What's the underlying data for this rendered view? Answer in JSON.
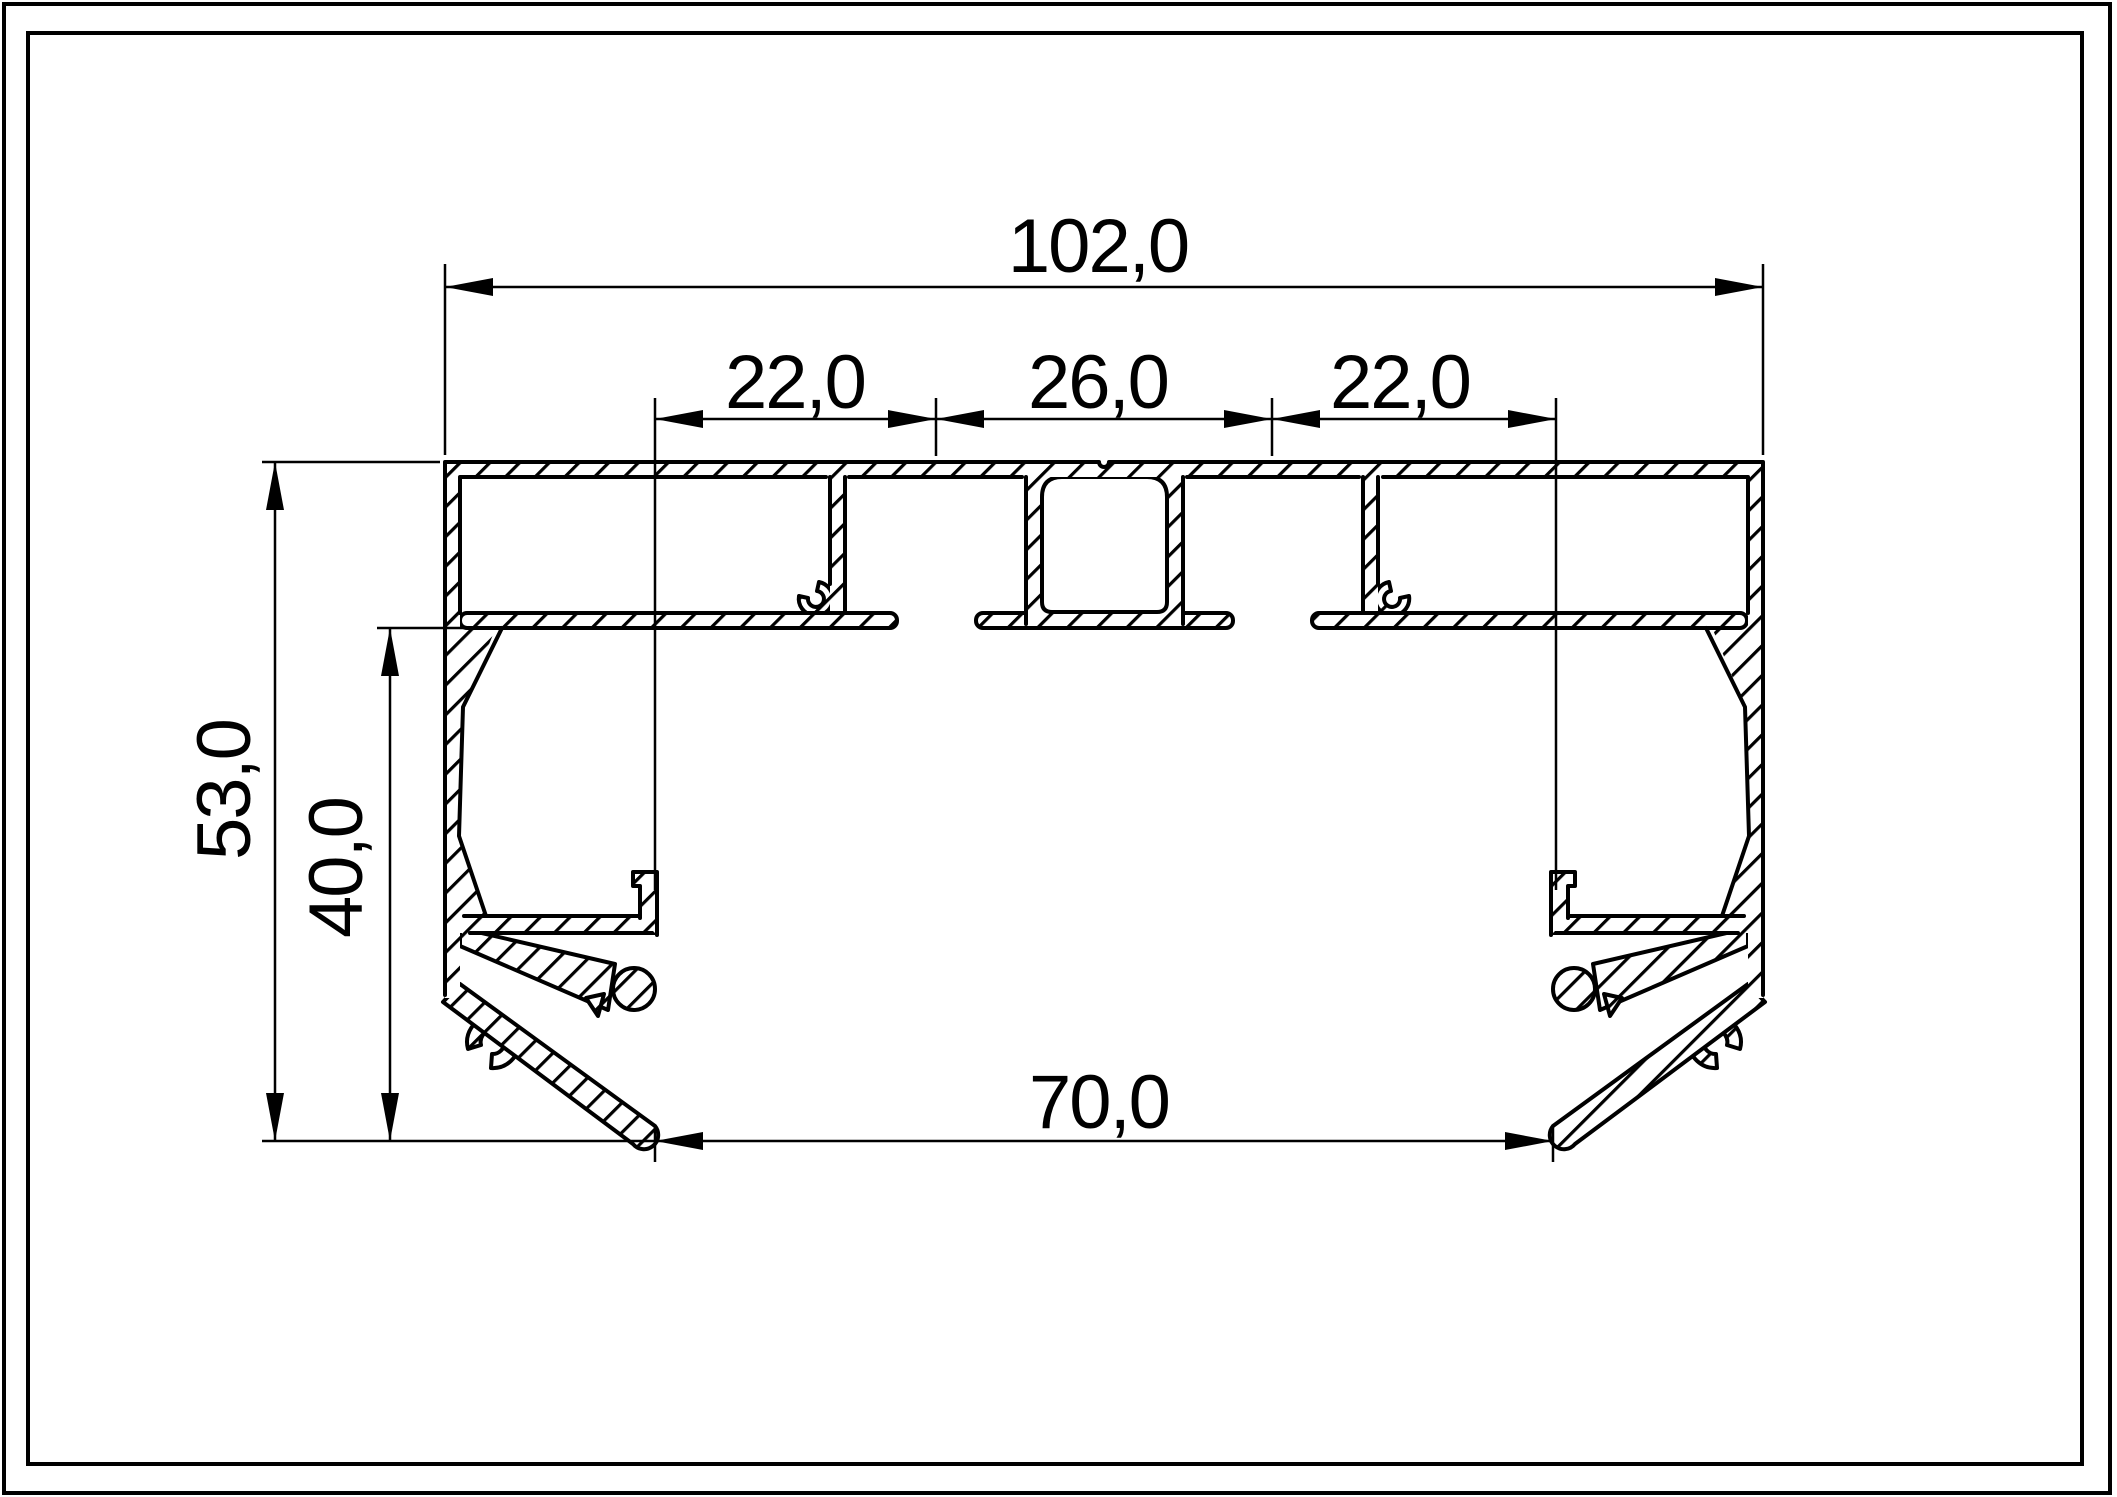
{
  "drawing": {
    "kind": "extrusion-profile-cross-section",
    "line_color": "#000000",
    "background_color": "#ffffff",
    "dimensions": {
      "overall_width": "102,0",
      "top_slot_left": "22,0",
      "top_center": "26,0",
      "top_slot_right": "22,0",
      "overall_height": "53,0",
      "inner_height": "40,0",
      "bottom_width": "70,0"
    }
  }
}
